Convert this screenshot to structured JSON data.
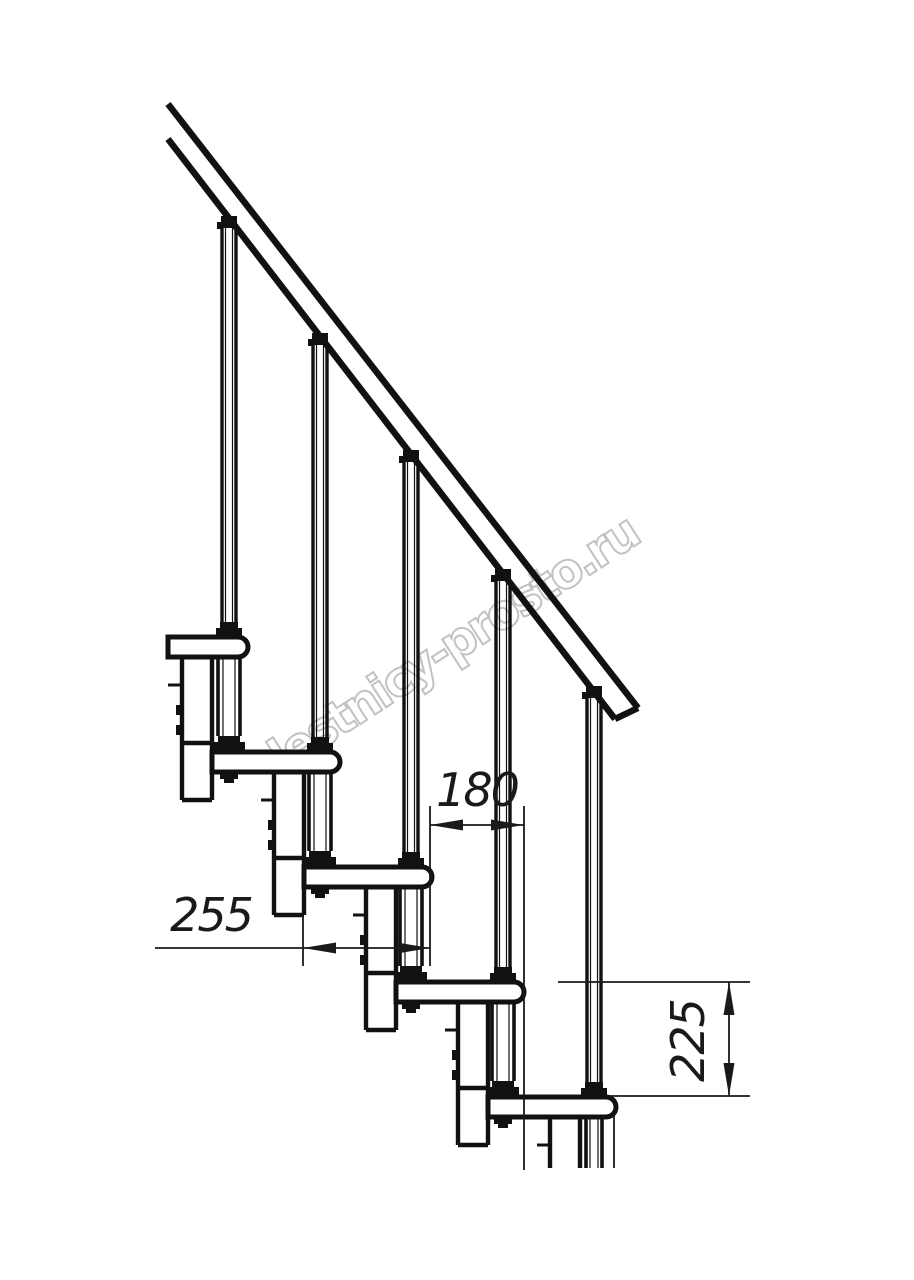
{
  "drawing": {
    "type": "modular-staircase-side-view",
    "background_color": "#ffffff",
    "line_color": "#111111",
    "watermark": {
      "text": "lestnicy-prosto.ru",
      "color": "#c2c2c2"
    },
    "dimensions": {
      "going": {
        "label": "180"
      },
      "tread_depth": {
        "label": "255"
      },
      "rise": {
        "label": "225"
      }
    },
    "counts": {
      "treads": 5,
      "balusters": 5
    }
  }
}
